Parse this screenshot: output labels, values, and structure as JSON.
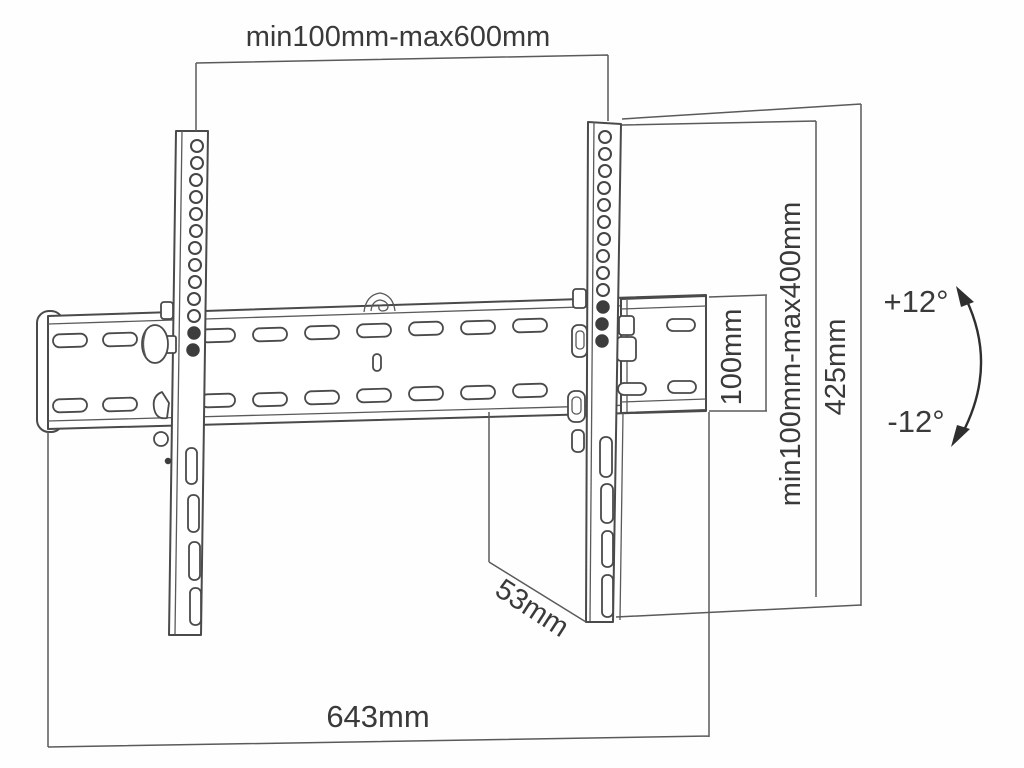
{
  "diagram": {
    "type": "technical-dimension-drawing",
    "subject": "tilting-tv-wall-mount-bracket",
    "colors": {
      "background": "#fefefe",
      "line": "#4a4a4a",
      "text": "#3a3a3a"
    },
    "labels": {
      "top_width": "min100mm-max600mm",
      "vesa_height": "min100mm-max400mm",
      "bracket_height": "425mm",
      "plate_end_height": "100mm",
      "depth": "53mm",
      "total_width": "643mm",
      "tilt_up": "+12°",
      "tilt_down": "-12°"
    }
  }
}
